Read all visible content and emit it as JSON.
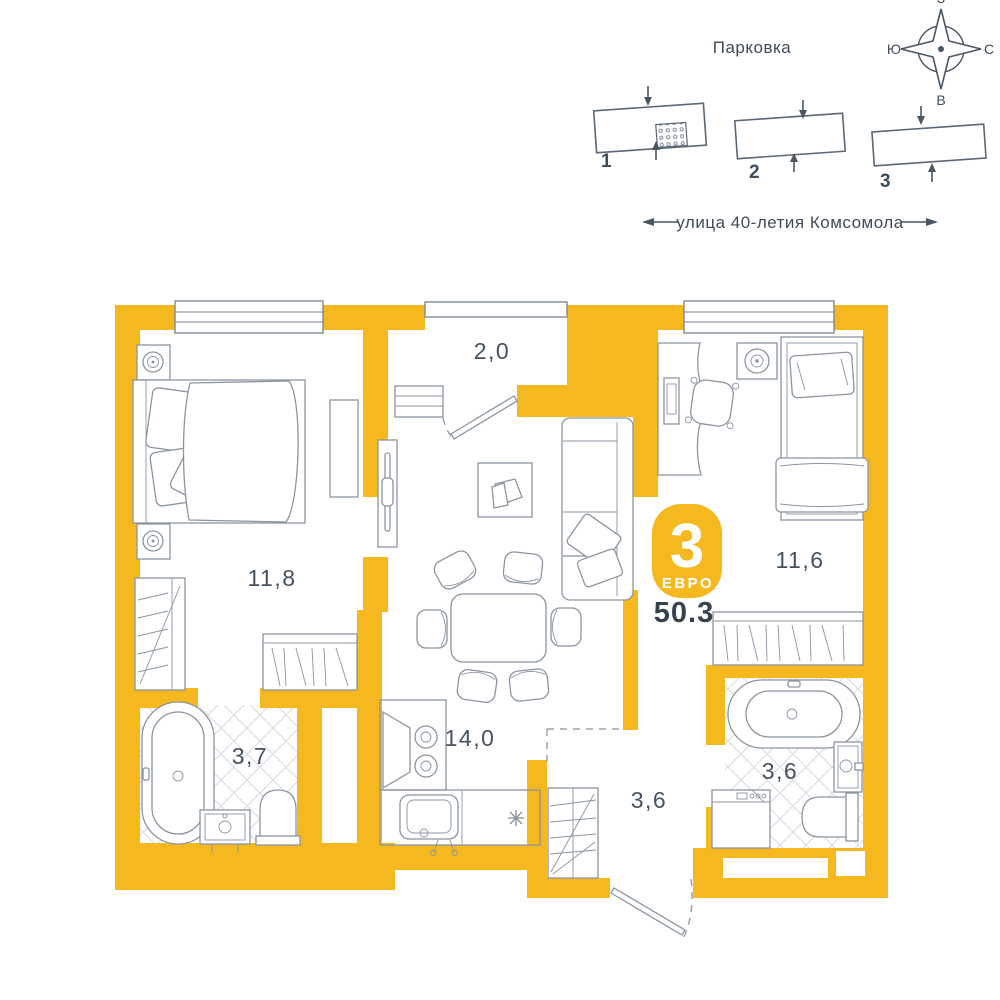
{
  "site_plan": {
    "parking_label": "Парковка",
    "street_label": "улица 40-летия Комсомола",
    "buildings": [
      {
        "number": "1"
      },
      {
        "number": "2"
      },
      {
        "number": "3"
      }
    ],
    "compass": {
      "top": "З",
      "bottom": "В",
      "left": "Ю",
      "right": "С"
    }
  },
  "apartment": {
    "badge": {
      "rooms_count": "3",
      "type_label": "ЕВРО"
    },
    "total_area": "50.3",
    "rooms": [
      {
        "id": "entry-hall",
        "area": "2,0"
      },
      {
        "id": "bedroom-left",
        "area": "11,8"
      },
      {
        "id": "bedroom-right",
        "area": "11,6"
      },
      {
        "id": "bathroom-left",
        "area": "3,7"
      },
      {
        "id": "kitchen-living-room",
        "area": "14,0"
      },
      {
        "id": "hallway",
        "area": "3,6"
      },
      {
        "id": "bathroom-right",
        "area": "3,6"
      }
    ]
  },
  "colors": {
    "wall_yellow": "#f5b81e",
    "furniture_line": "#8b95a1",
    "text_dark": "#3f4c5a"
  }
}
